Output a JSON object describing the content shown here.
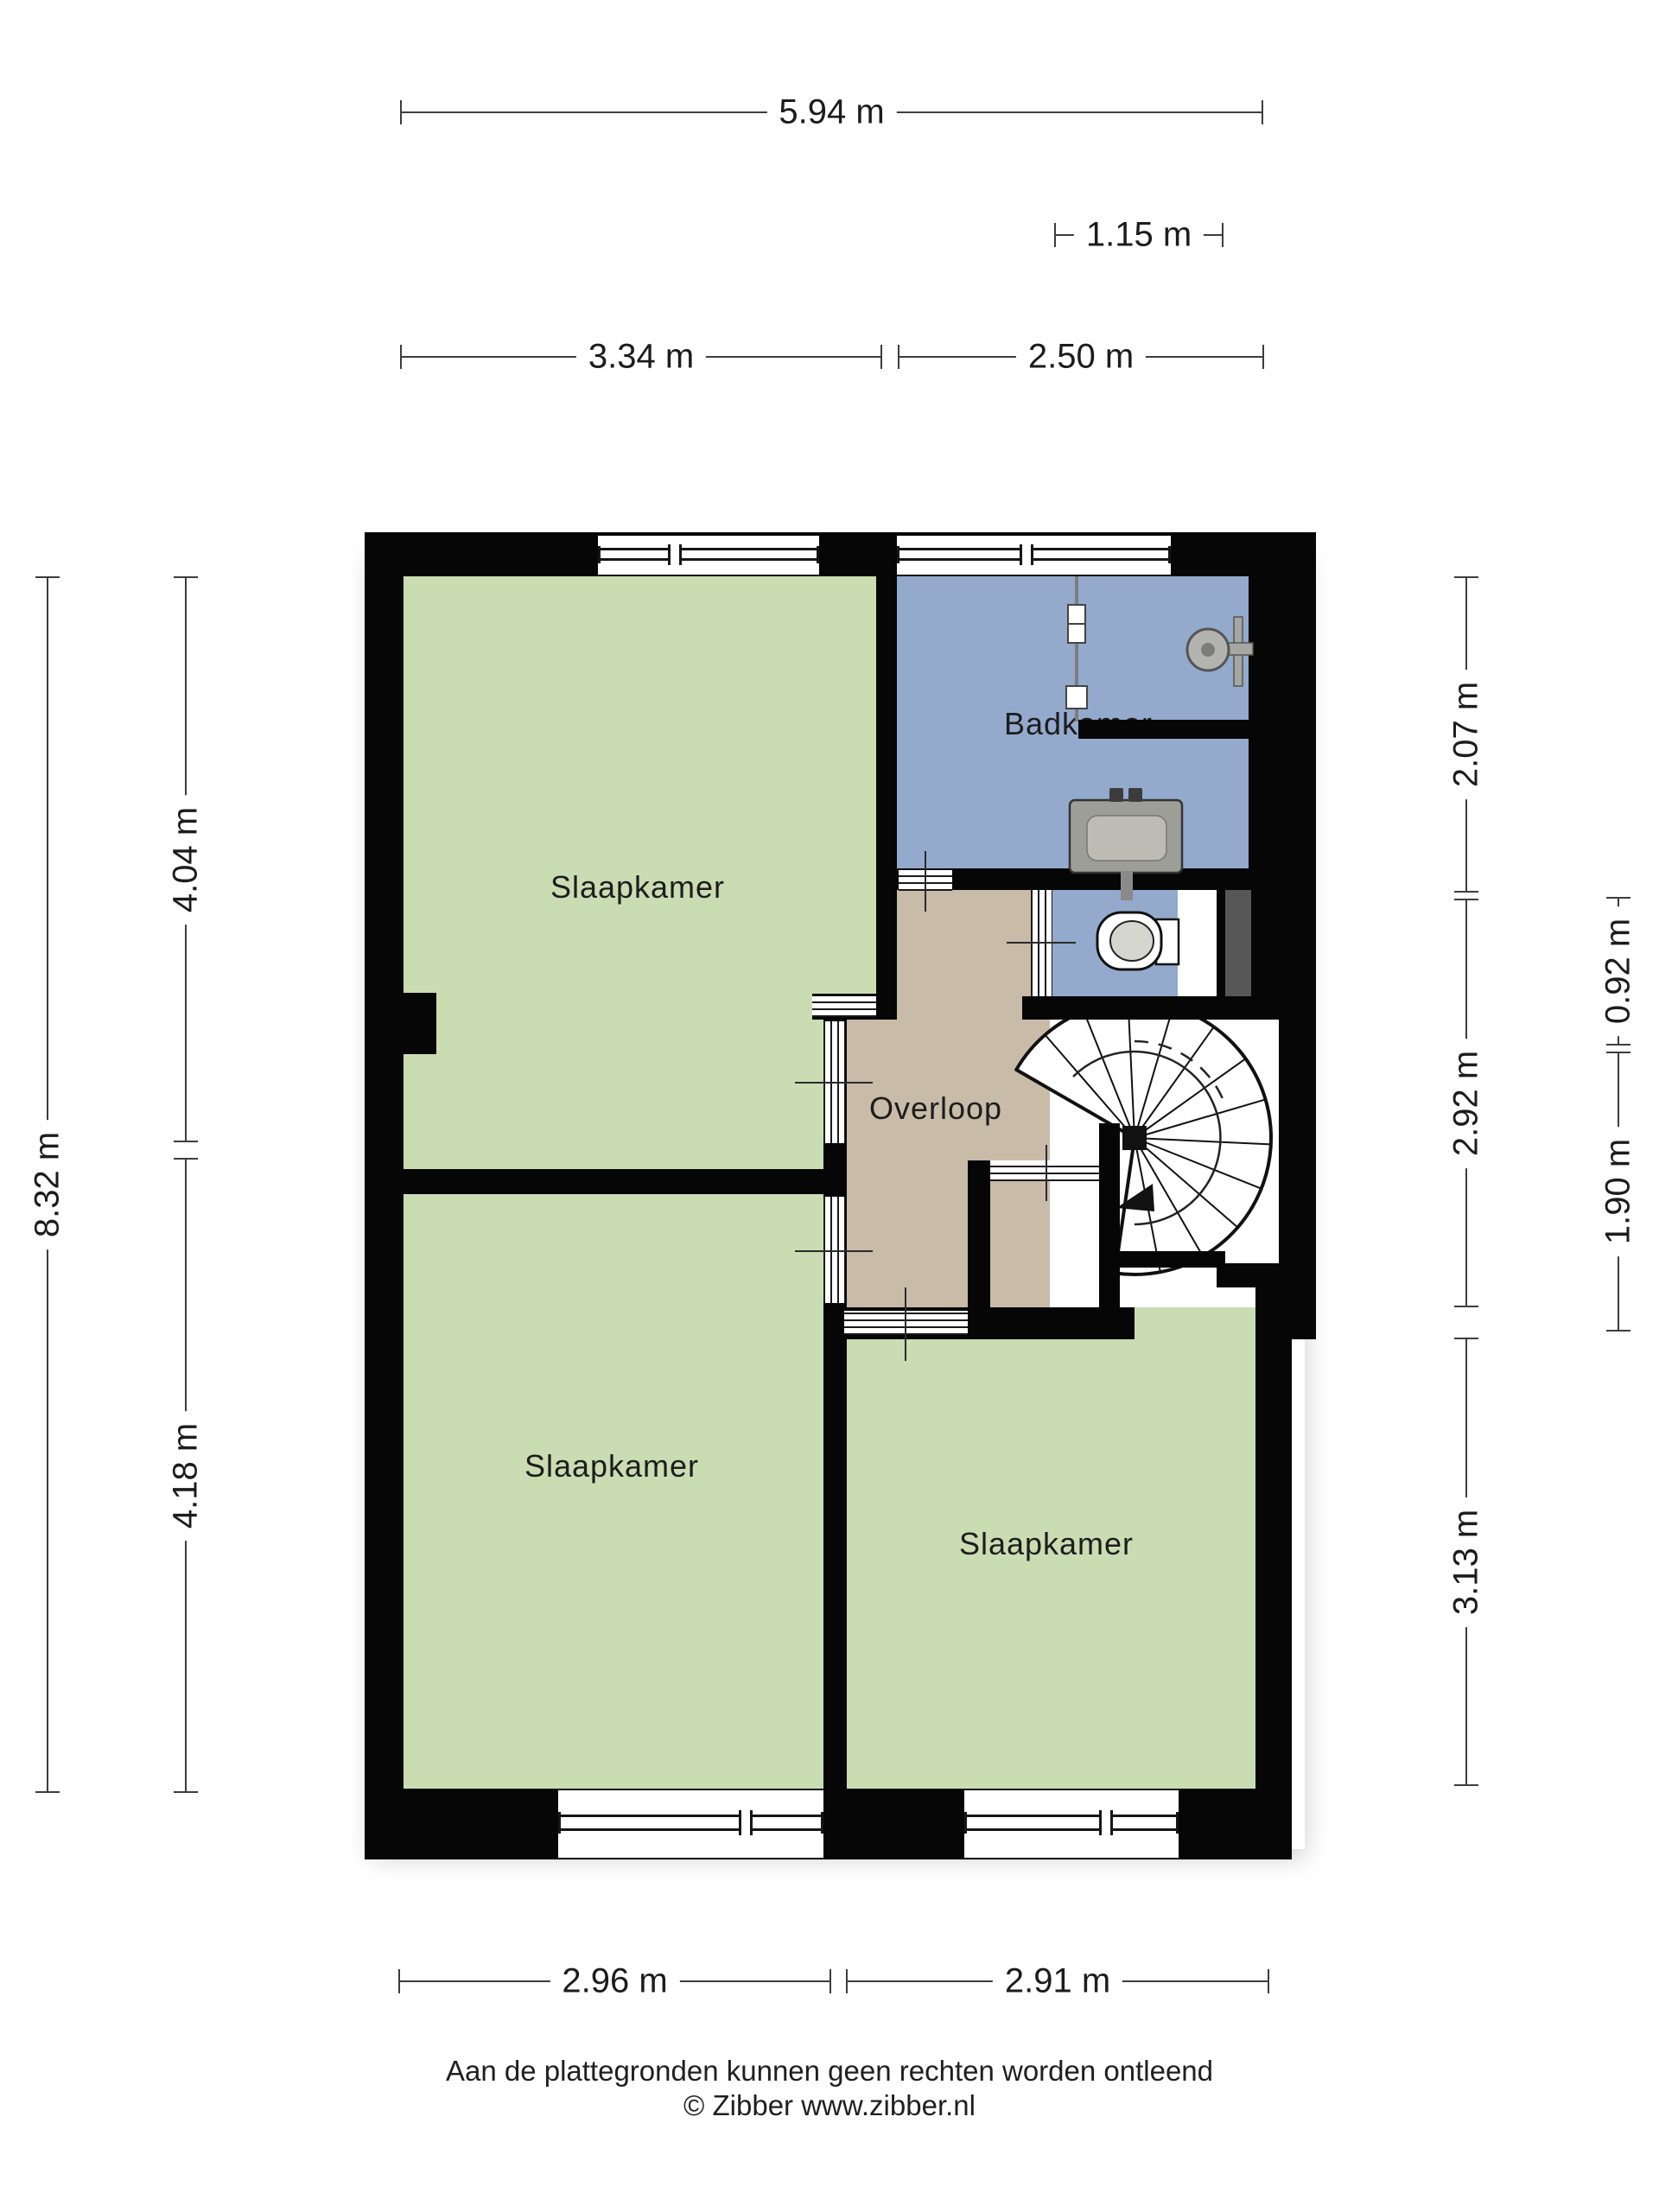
{
  "title": "Floor plan – first floor (verdieping)",
  "colors": {
    "room_green": "#caddb2",
    "room_blue": "#93aacd",
    "room_tan": "#c8bba8",
    "wall": "#060606",
    "niche_gray": "#575757",
    "fixture_gray": "#a9a9a4",
    "dim_text": "#1c1c1c",
    "line": "#3d3d3d"
  },
  "rooms": {
    "bedroom_tl": "Slaapkamer",
    "bedroom_bl": "Slaapkamer",
    "bedroom_br": "Slaapkamer",
    "bathroom": "Badkamer",
    "landing": "Overloop"
  },
  "dimensions": {
    "top_total": "5.94 m",
    "top_small": "1.15 m",
    "top_left": "3.34 m",
    "top_right": "2.50 m",
    "left_total": "8.32 m",
    "left_upper": "4.04 m",
    "left_lower": "4.18 m",
    "right_upper": "2.07 m",
    "right_middle": "2.92 m",
    "right_lower": "3.13 m",
    "right_inner_upper": "0.92 m",
    "right_inner_lower": "1.90 m",
    "bottom_left": "2.96 m",
    "bottom_right": "2.91 m"
  },
  "footer": {
    "disclaimer": "Aan de plattegronden kunnen geen rechten worden ontleend",
    "credit": "© Zibber www.zibber.nl"
  }
}
